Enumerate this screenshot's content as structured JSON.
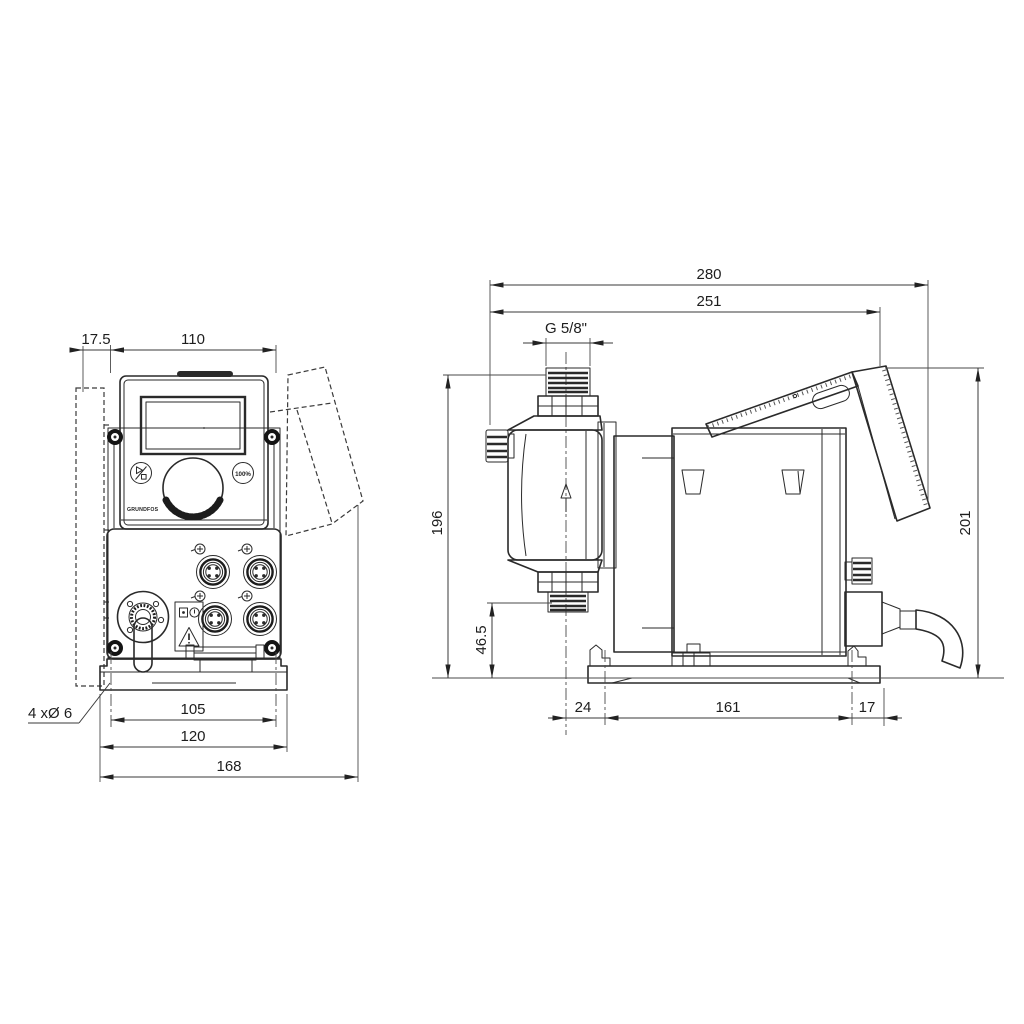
{
  "drawing": {
    "background": "#ffffff",
    "line_color": "#2a2a2a",
    "front_view": {
      "dims": {
        "offset": "17.5",
        "panel_width": "110",
        "hole_spacing": "105",
        "plate_width": "120",
        "total_width": "168",
        "holes_note": "4 xØ 6"
      },
      "panel": {
        "logo": "GRUNDFOS",
        "button_right_label": "100%"
      },
      "icons": {
        "button_left": "start-stop-icon",
        "label_top": "read-manual-icon",
        "label_bottom": "warning-triangle-icon"
      }
    },
    "side_view": {
      "dims": {
        "total_length": "280",
        "housing_length": "251",
        "thread": "G 5/8\"",
        "height_connection": "196",
        "suction_height": "46.5",
        "total_height": "201",
        "foot_front": "24",
        "foot_hole_spacing": "161",
        "foot_rear": "17"
      },
      "icons": {
        "flow_direction": "flow-arrow-up-icon"
      }
    }
  }
}
